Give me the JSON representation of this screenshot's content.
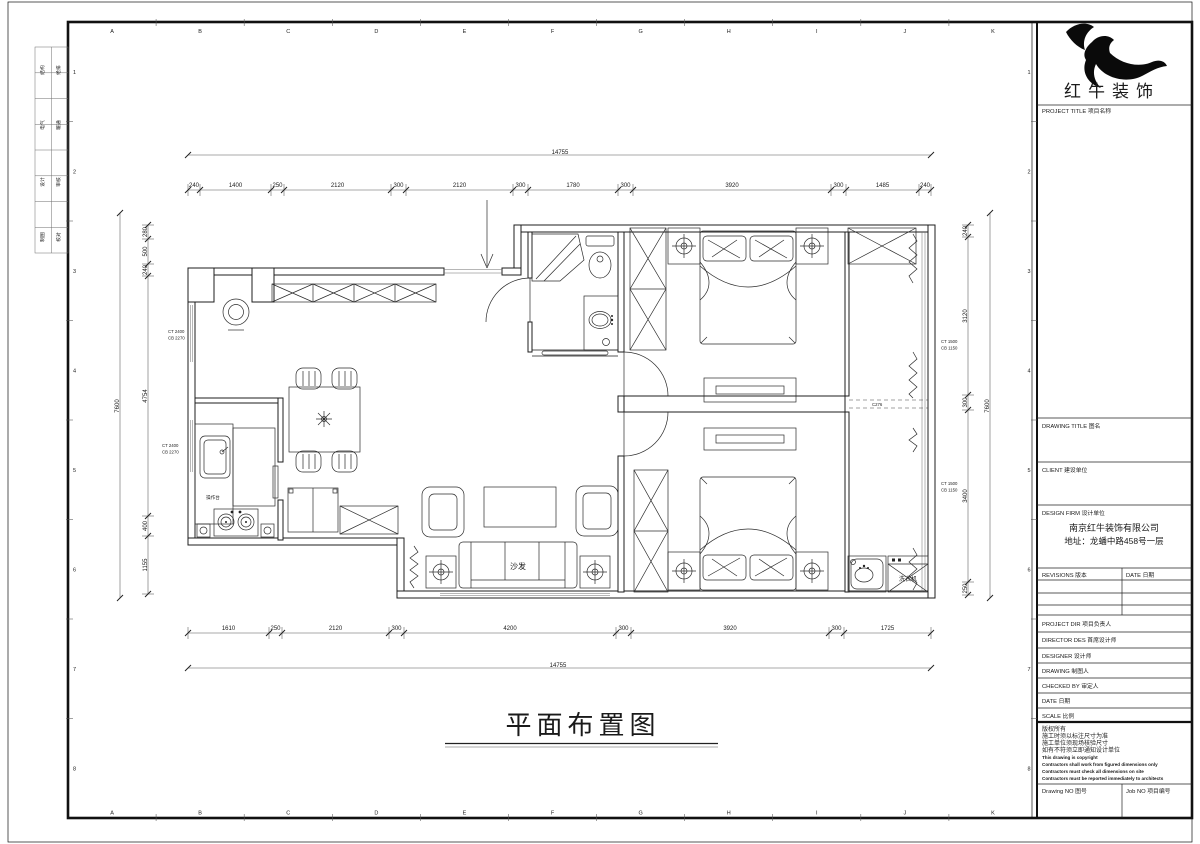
{
  "title": "平面布置图",
  "sheet": {
    "grid_letters": [
      "A",
      "B",
      "C",
      "D",
      "E",
      "F",
      "G",
      "H",
      "I",
      "J",
      "K"
    ],
    "grid_numbers": [
      "1",
      "2",
      "3",
      "4",
      "5",
      "6",
      "7",
      "8"
    ],
    "sign_strip": [
      [
        "结构",
        "给排"
      ],
      [
        "电气",
        "暖通"
      ],
      [
        "设计",
        "审核"
      ],
      [
        "制图",
        "校对"
      ]
    ]
  },
  "dims": {
    "top_overall": "14755",
    "bottom_overall": "14755",
    "left_overall": "7600",
    "right_overall": "7600",
    "top": [
      "240",
      "1400",
      "250",
      "2120",
      "300",
      "2120",
      "300",
      "1780",
      "300",
      "3920",
      "300",
      "1485",
      "240"
    ],
    "bottom": [
      "1610",
      "250",
      "2120",
      "300",
      "4200",
      "300",
      "3920",
      "300",
      "1725"
    ],
    "left": [
      "280",
      "500",
      "240",
      "4754",
      "400",
      "1155"
    ],
    "right": [
      "240",
      "3120",
      "300",
      "3400",
      "250"
    ]
  },
  "labels": {
    "sofa": "沙发",
    "washer": "洗衣机",
    "counter": "操作台"
  },
  "annotations": {
    "window_marks": [
      [
        "CT 2400",
        "CB 2270"
      ],
      [
        "CT 2400",
        "CB 2270"
      ],
      [
        "CT 1500",
        "CB 1150"
      ],
      [
        "CT 1500",
        "CB 1150"
      ]
    ],
    "balcony_mark": "C276"
  },
  "titleblock": {
    "logo_text": "红牛装饰",
    "project_title": "PROJECT TITLE  项目名称",
    "drawing_title": "DRAWING TITLE  图名",
    "client": "CLIENT  建设单位",
    "design_firm": "DESIGN FIRM  设计单位",
    "company": "南京红牛装饰有限公司",
    "address": "地址：龙蟠中路458号一层",
    "revisions": "REVISIONS  版本",
    "date_col": "DATE  日期",
    "project_dir": "PROJECT DIR  项目负责人",
    "director_des": "DIRECTOR DES  首席设计师",
    "designer": "DESIGNER  设计师",
    "drawing_by": "DRAWING  制图人",
    "checked_by": "CHECKED BY  审定人",
    "date": "DATE  日期",
    "scale": "SCALE  比例",
    "notes": [
      "版权所有",
      "施工时须以标注尺寸为准",
      "施工单位须现场核验尺寸",
      "如有不符须立即通知设计单位",
      "This drawing is copyright",
      "Contractors shall work from figured dimensions only",
      "Contractors must check all dimensions on site",
      "Contractors must be reported immediately to architects"
    ],
    "drawing_no": "Drawing NO  图号",
    "job_no": "Job NO  项目编号"
  }
}
